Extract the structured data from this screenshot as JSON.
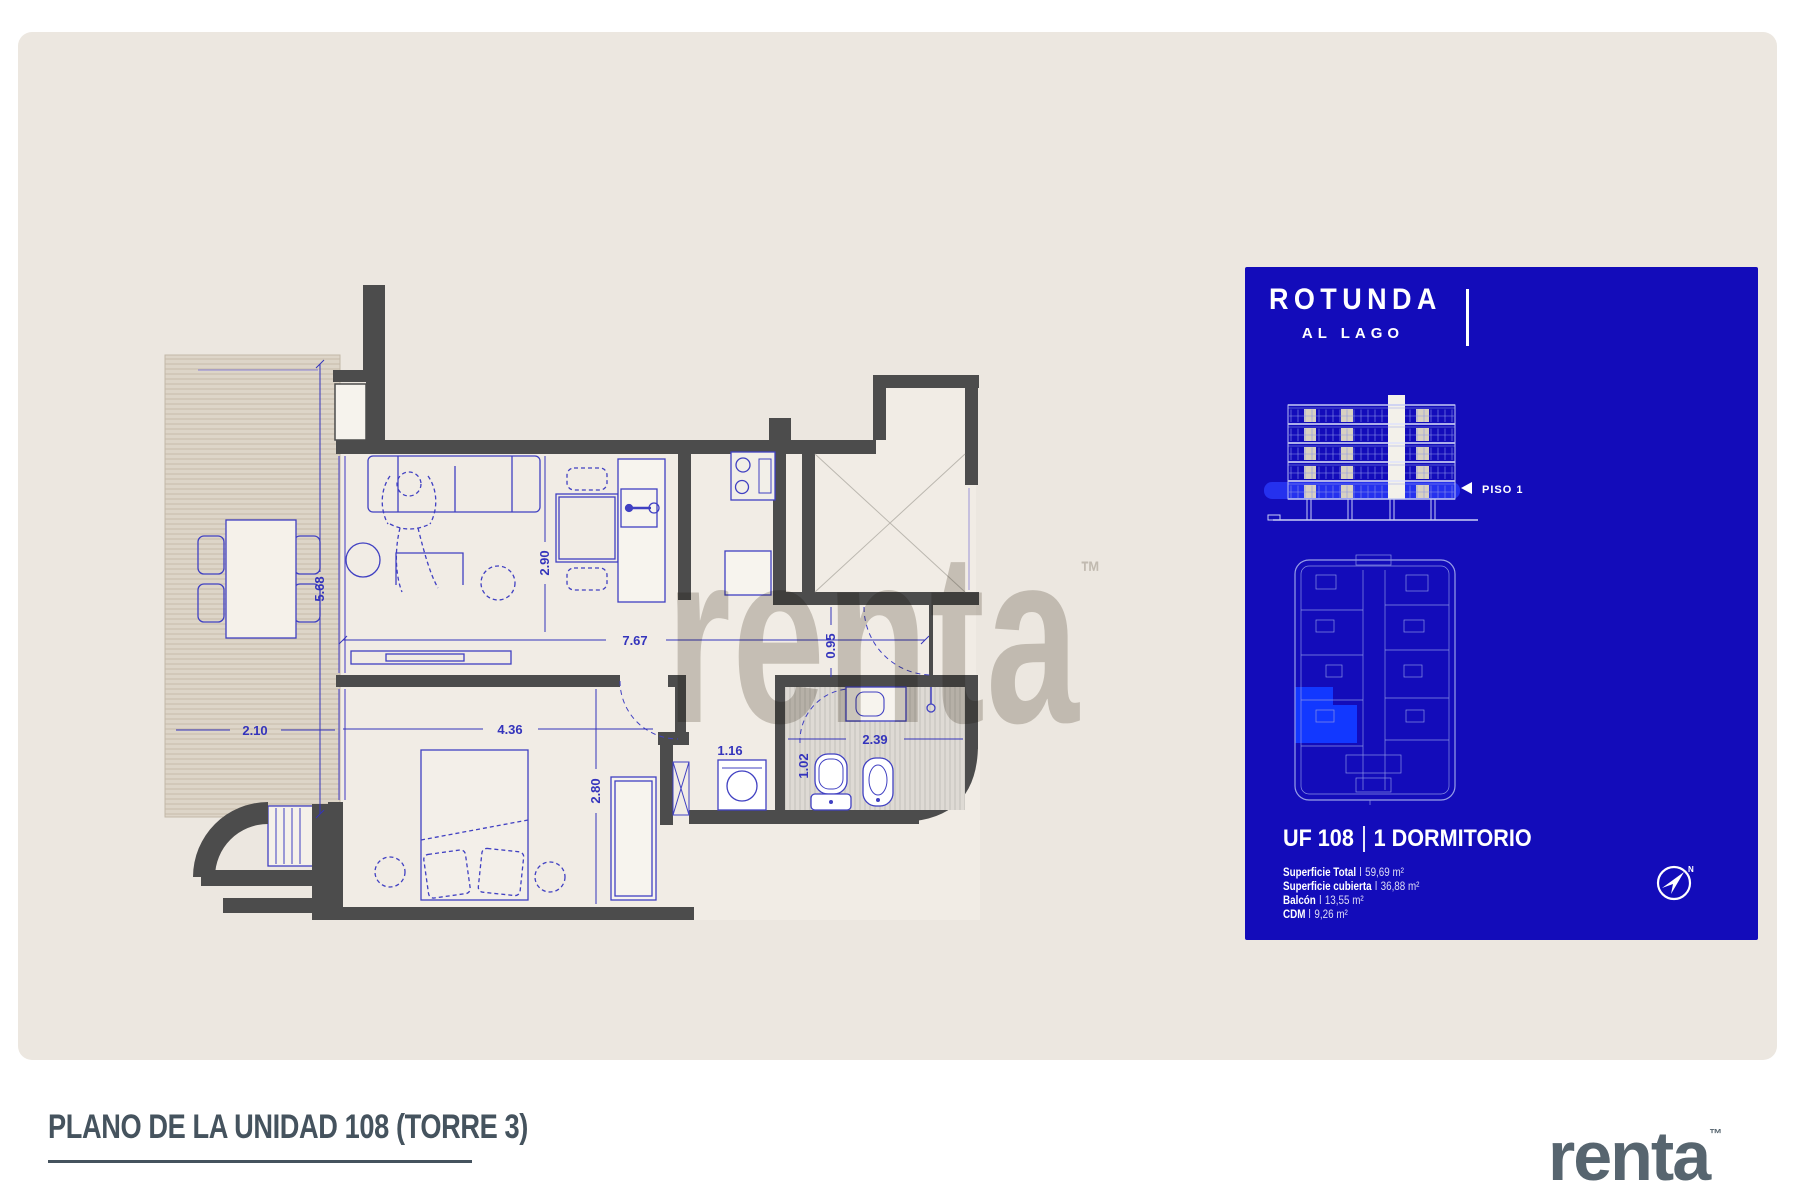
{
  "page": {
    "background": "#ffffff",
    "panel_color": "#ece7e0"
  },
  "watermark": {
    "text": "renta",
    "tm": "™"
  },
  "plan": {
    "dimensions": [
      {
        "value": "5.68"
      },
      {
        "value": "2.10"
      },
      {
        "value": "2.90"
      },
      {
        "value": "7.67"
      },
      {
        "value": "0.95"
      },
      {
        "value": "4.36"
      },
      {
        "value": "2.80"
      },
      {
        "value": "1.16"
      },
      {
        "value": "1.02"
      },
      {
        "value": "2.39"
      }
    ]
  },
  "card": {
    "background": "#130cba",
    "accent": "#2531ee",
    "highlight": "#1238ff",
    "brand_line1": "ROTUNDA",
    "brand_line2": "AL LAGO",
    "floor_label": "PISO 1",
    "unit_number": "UF 108",
    "unit_type": "1 DORMITORIO",
    "details": [
      {
        "label": "Superficie Total",
        "value": "59,69 m²"
      },
      {
        "label": "Superficie cubierta",
        "value": "36,88 m²"
      },
      {
        "label": "Balcón",
        "value": "13,55 m²"
      },
      {
        "label": "CDM",
        "value": "9,26 m²"
      }
    ],
    "compass_n": "N"
  },
  "footer": {
    "title": "PLANO DE LA UNIDAD 108 (TORRE 3)",
    "brand": "renta",
    "brand_tm": "™"
  }
}
